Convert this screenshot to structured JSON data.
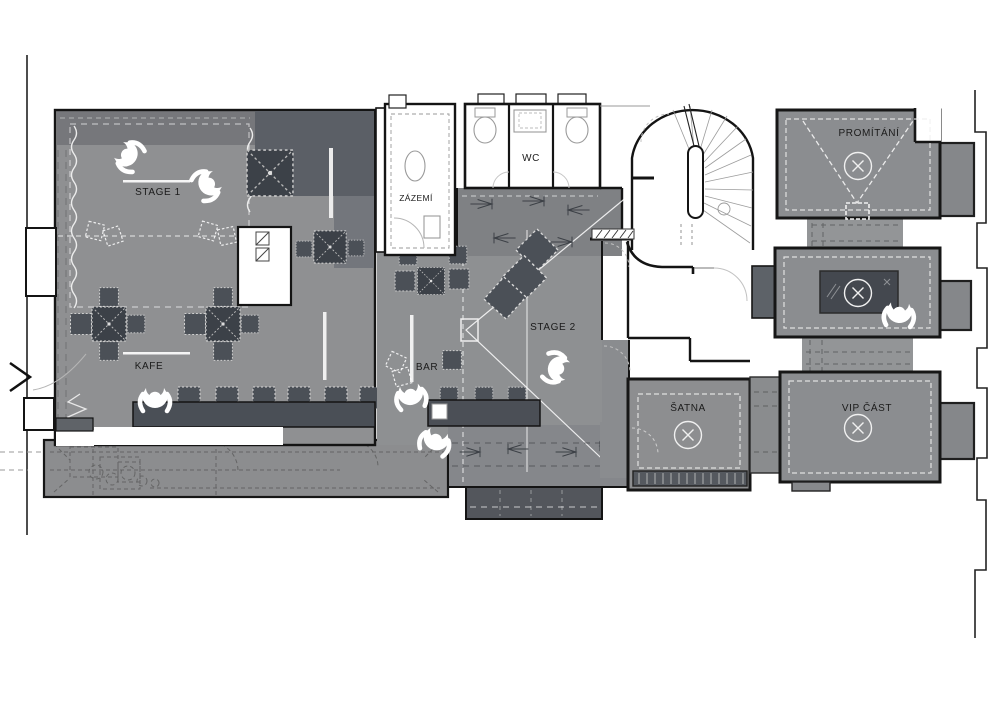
{
  "plan": {
    "type": "floor-plan",
    "rooms": [
      {
        "id": "stage-1",
        "label": "STAGE 1"
      },
      {
        "id": "kafe",
        "label": "KAFE"
      },
      {
        "id": "zazemi",
        "label": "ZÁZEMÍ"
      },
      {
        "id": "wc",
        "label": "WC"
      },
      {
        "id": "bar",
        "label": "BAR"
      },
      {
        "id": "stage-2",
        "label": "STAGE 2"
      },
      {
        "id": "satna",
        "label": "ŠATNA"
      },
      {
        "id": "vip",
        "label": "VIP ČÁST"
      },
      {
        "id": "promitani",
        "label": "PROMÍTÁNÍ"
      }
    ],
    "icons": [
      "person-top-icon",
      "circle-x-light-icon",
      "table-x-icon",
      "chair-icon",
      "entrance-arrow-icon",
      "spiral-stairs-icon",
      "toilet-icon",
      "sink-icon",
      "coat-rack-icon",
      "curtain-icon",
      "projection-cone-icon"
    ],
    "symbol_counts": {
      "people": 7,
      "circle_x_lights": 4
    },
    "colors": {
      "background": "#ffffff",
      "floor": "#8f9092",
      "floor_dark": "#5b5f66",
      "furniture_dark": "#3e434b",
      "wall": "#161616",
      "marking_white": "#f2f2f2"
    }
  }
}
